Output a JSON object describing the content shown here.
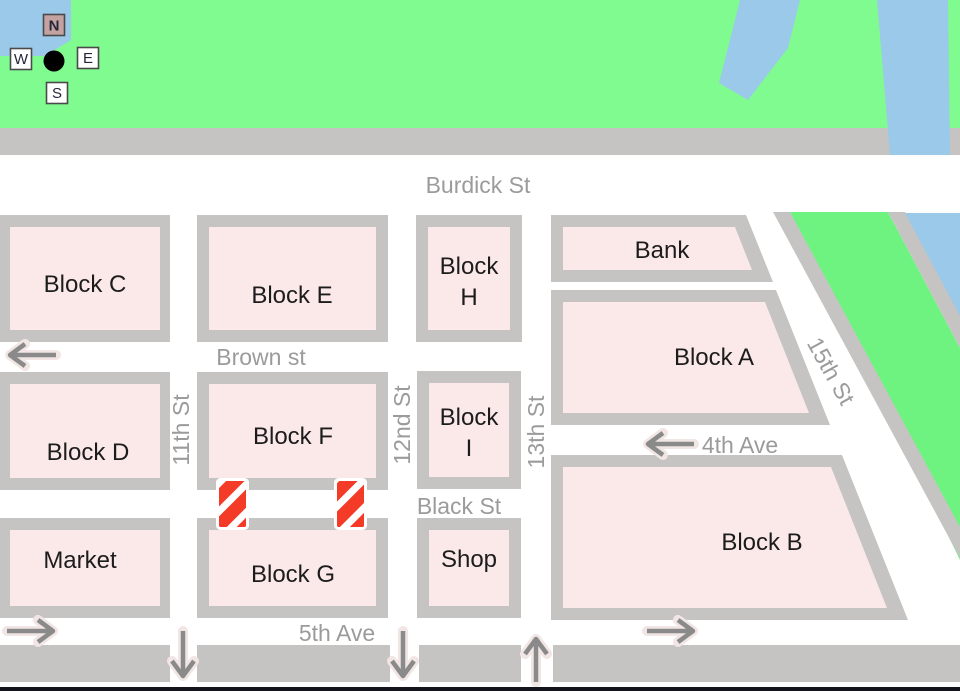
{
  "compass": {
    "n": "N",
    "w": "W",
    "e": "E",
    "s": "S"
  },
  "streets": {
    "burdick": "Burdick St",
    "brown": "Brown st",
    "black": "Black St",
    "fifth": "5th Ave",
    "fourth": "4th Ave",
    "eleventh": "11th St",
    "twelfth": "12nd St",
    "thirteenth": "13th St",
    "fifteenth": "15th St"
  },
  "blocks": {
    "c": "Block C",
    "e": "Block E",
    "h1": "Block",
    "h2": "H",
    "bank": "Bank",
    "a": "Block A",
    "d": "Block D",
    "f": "Block F",
    "i1": "Block",
    "i2": "I",
    "b": "Block B",
    "market": "Market",
    "g": "Block G",
    "shop": "Shop"
  },
  "colors": {
    "park": "#80fb8f",
    "greenway": "#6ef381",
    "water": "#9ac9e9",
    "road": "#c5c4c3",
    "block": "#fbe9e9",
    "red": "#f43b28",
    "label": "#9b9b9b",
    "ink": "#1c1c1c",
    "arrow": "#8a8a8a",
    "halo": "#f1e6e4",
    "edge": "#14141c",
    "nbg": "#c4a2a2",
    "boxborder": "#4a4a4a"
  }
}
